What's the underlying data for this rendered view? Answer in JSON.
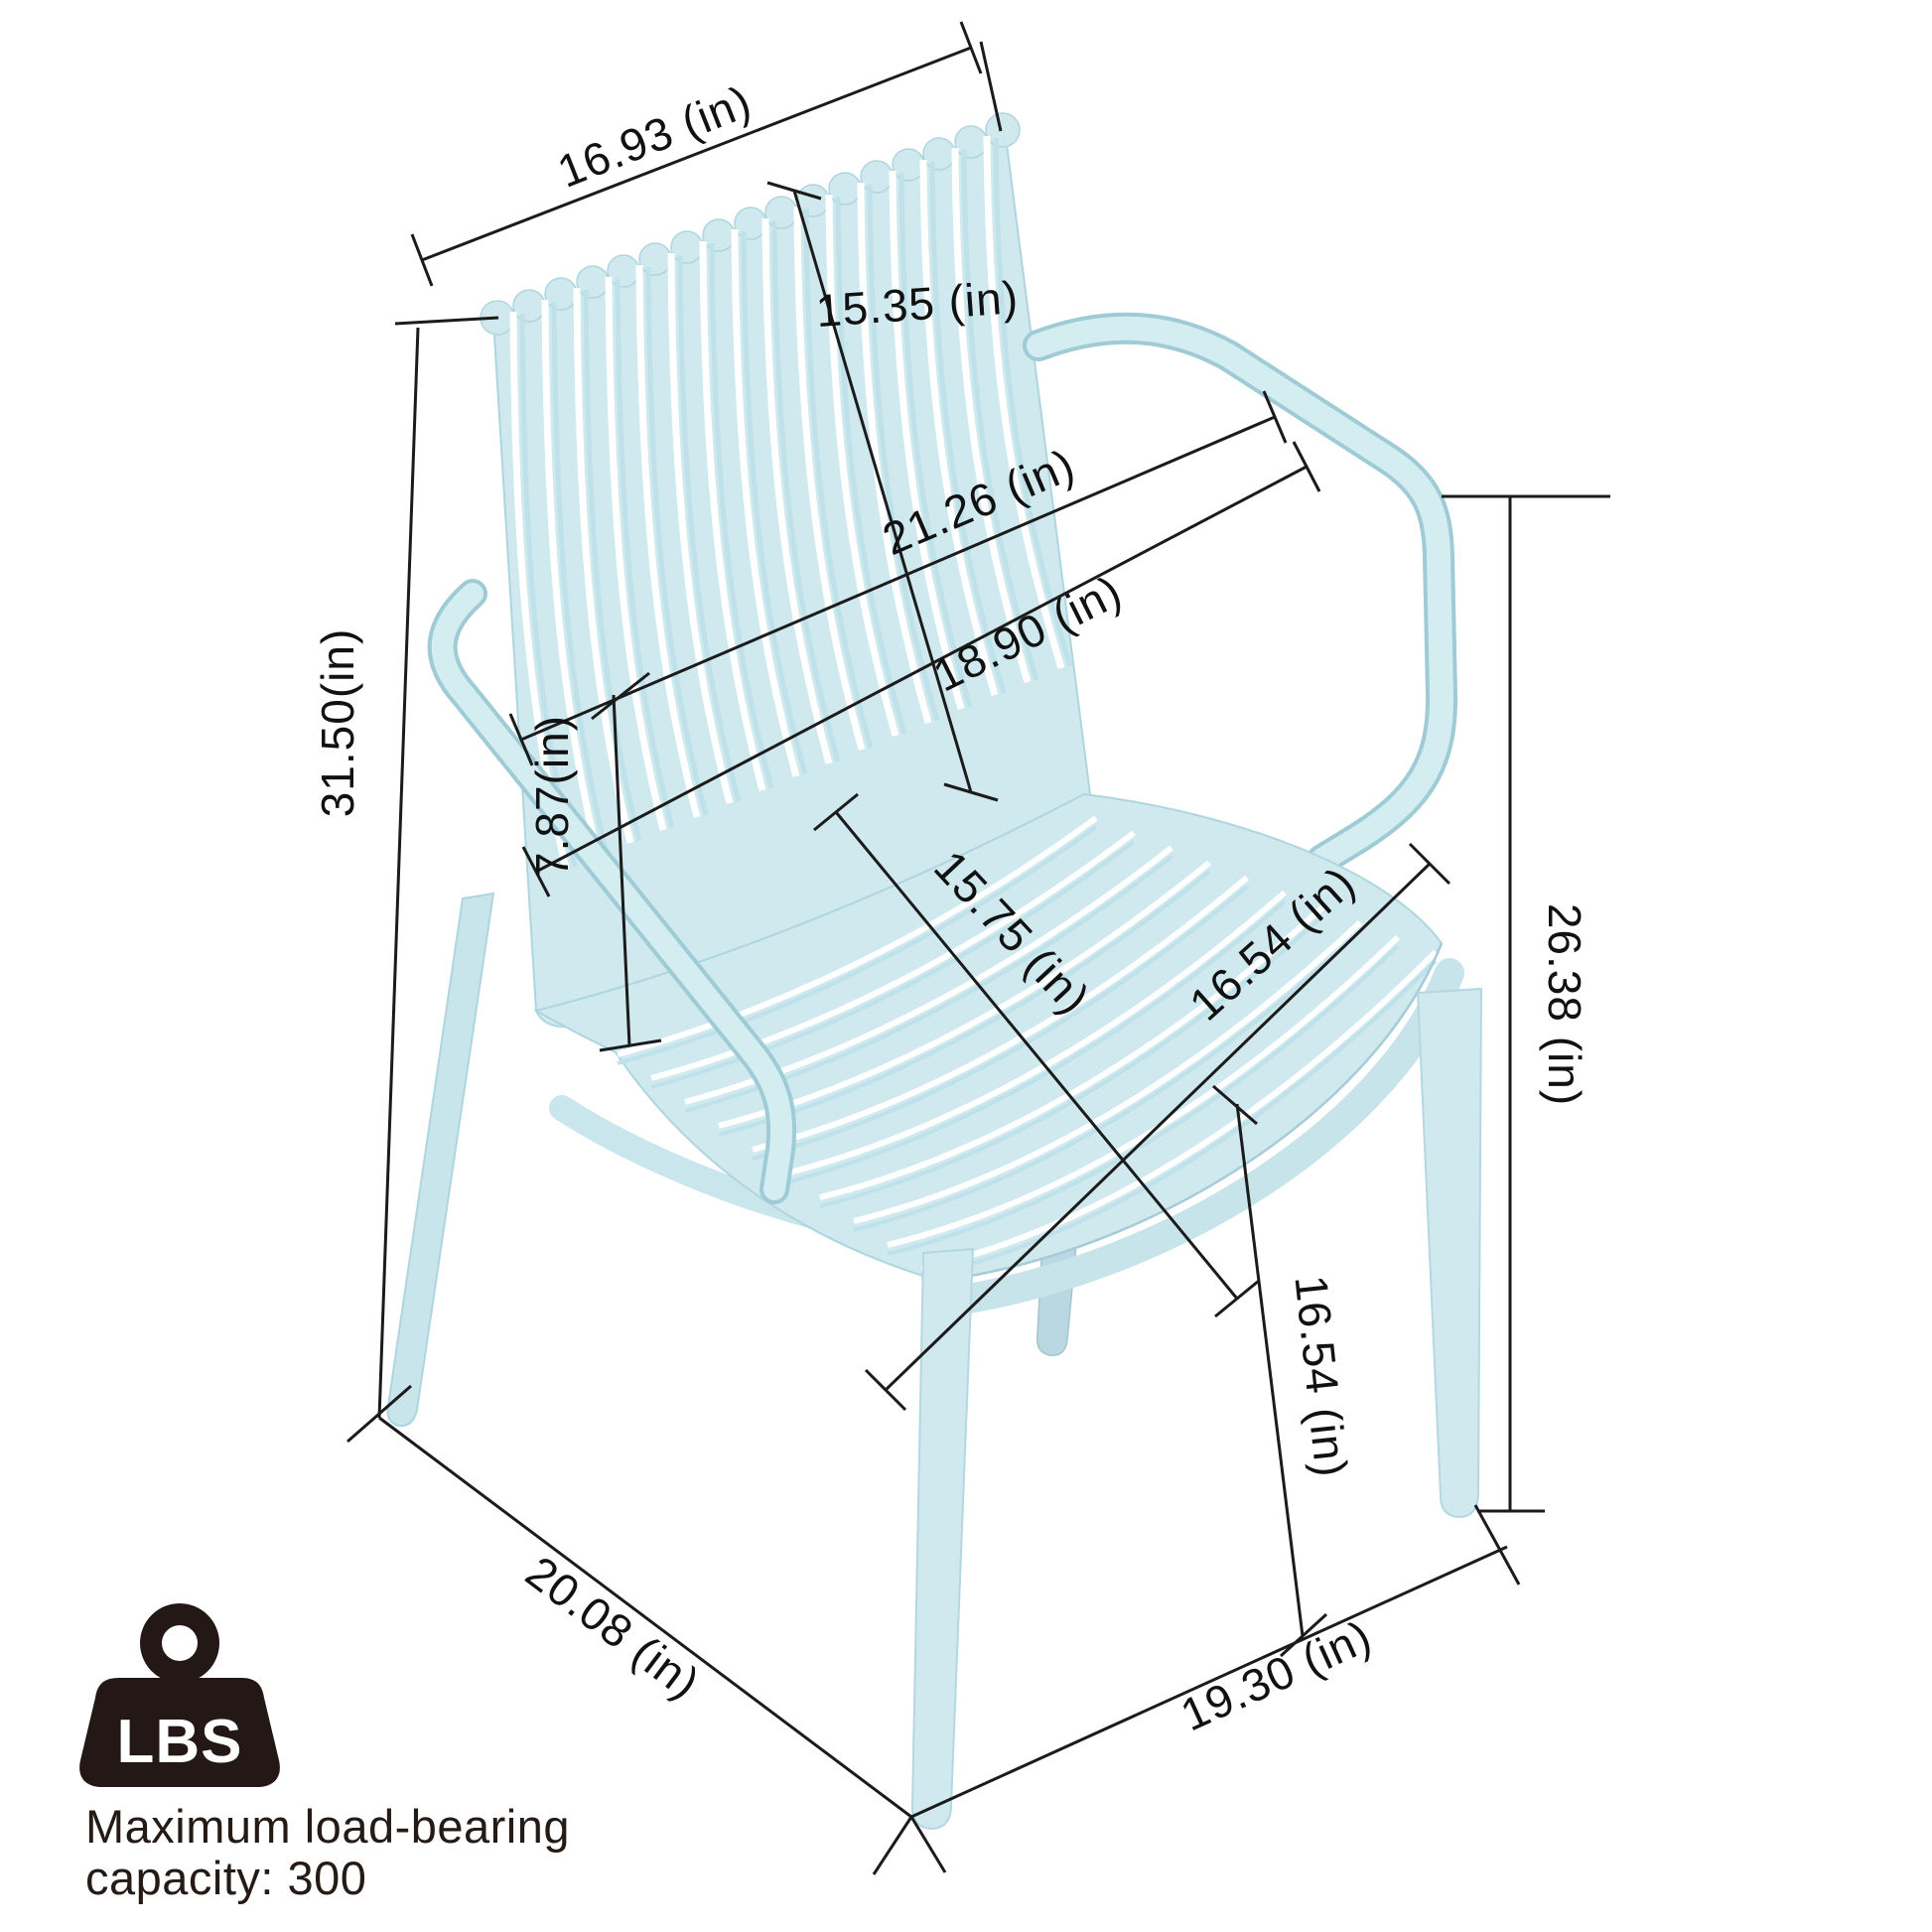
{
  "dimensions": {
    "back_width": "16.93 (in)",
    "back_height": "15.35 (in)",
    "seat_back_span": "21.26 (in)",
    "armrest_span": "18.90 (in)",
    "overall_height": "31.50(in)",
    "armrest_to_seat_height": "7.87(in)",
    "seat_depth": "15.75 (in)",
    "seat_width": "16.54 (in)",
    "floor_to_armrest_height": "26.38 (in)",
    "seat_height": "16.54 (in)",
    "overall_depth": "20.08 (in)",
    "overall_width": "19.30 (in)"
  },
  "load_capacity": {
    "icon_text": "LBS",
    "caption_line1": "Maximum load-bearing",
    "caption_line2": "capacity: 300"
  },
  "colors": {
    "chair_base": "#cfe9ee",
    "chair_shade": "#bfe1e9",
    "chair_edge": "#a5ccd7",
    "dimension_line": "#1b1b1b",
    "label_text": "#111111",
    "badge": "#231815",
    "background": "#ffffff"
  }
}
